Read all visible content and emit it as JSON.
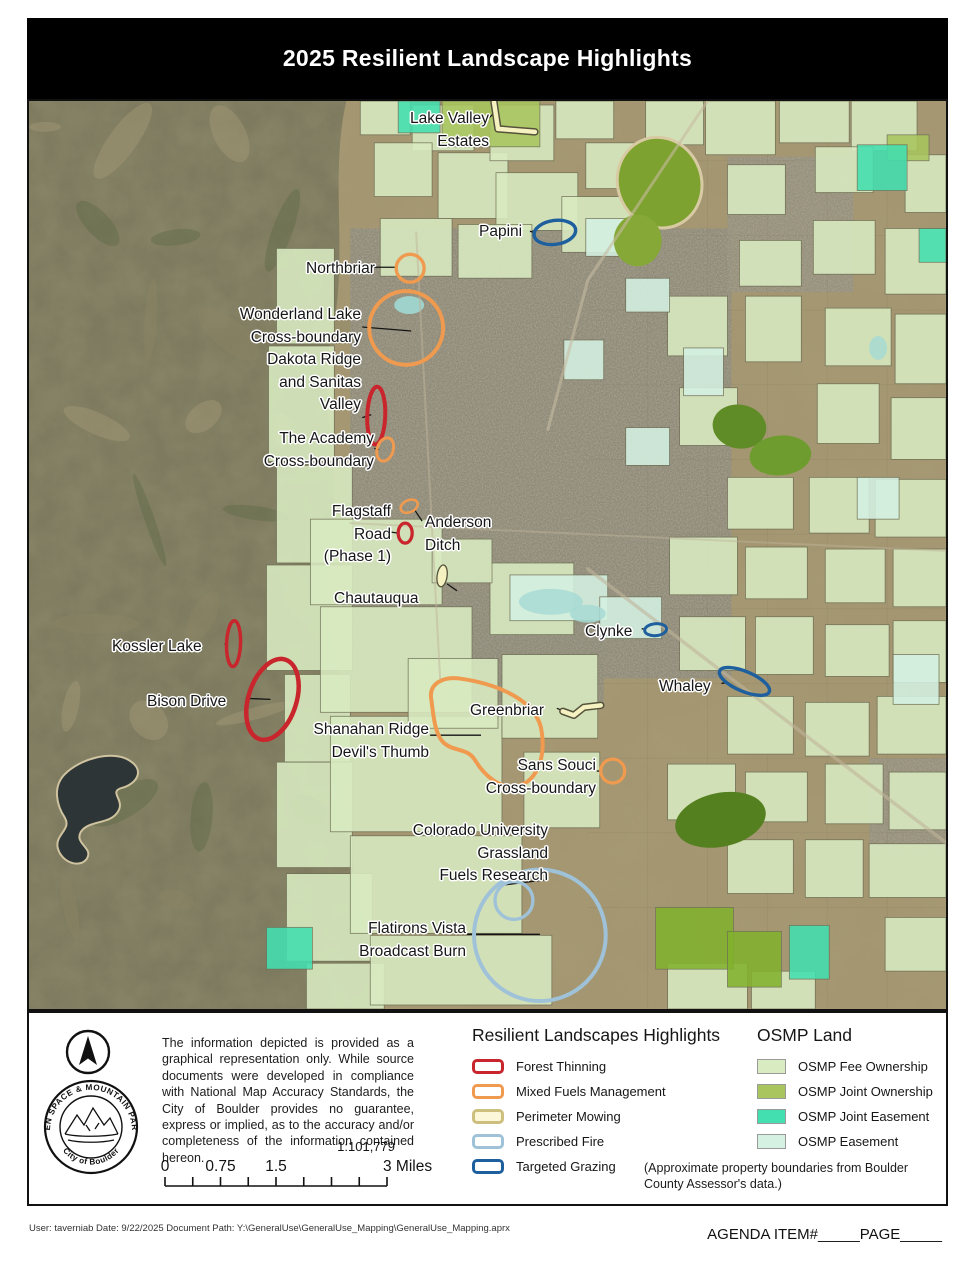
{
  "title": "2025 Resilient Landscape Highlights",
  "colors": {
    "forest_thinning": "#C9252C",
    "mixed_fuels": "#EF9A4F",
    "perimeter_fill": "#F6F1C0",
    "perimeter_casing": "#55523C",
    "perimeter_legend_border": "#CDBF7D",
    "prescribed_fire": "#9FC2D8",
    "targeted_grazing": "#1E5F9E",
    "fee_ownership": "#D9EBC1",
    "joint_ownership": "#A9C55E",
    "joint_easement": "#43DFB0",
    "easement": "#D4F1E2",
    "leader": "#151515"
  },
  "map_labels": [
    {
      "id": "lake-valley-estates",
      "lines": [
        "Lake Valley",
        "Estates"
      ],
      "align": "right",
      "x": 460,
      "y": 7
    },
    {
      "id": "papini",
      "lines": [
        "Papini"
      ],
      "align": "left",
      "x": 450,
      "y": 120
    },
    {
      "id": "northbriar",
      "lines": [
        "Northbriar"
      ],
      "align": "left",
      "x": 277,
      "y": 157
    },
    {
      "id": "wonderland",
      "lines": [
        "Wonderland Lake",
        "Cross-boundary"
      ],
      "align": "right",
      "x": 332,
      "y": 203
    },
    {
      "id": "dakota",
      "lines": [
        "Dakota Ridge",
        "and Sanitas",
        "Valley"
      ],
      "align": "right",
      "x": 332,
      "y": 248
    },
    {
      "id": "academy",
      "lines": [
        "The Academy",
        "Cross-boundary"
      ],
      "align": "right",
      "x": 345,
      "y": 327
    },
    {
      "id": "flagstaff",
      "lines": [
        "Flagstaff",
        "Road",
        "(Phase 1)"
      ],
      "align": "right",
      "x": 362,
      "y": 400
    },
    {
      "id": "anderson",
      "lines": [
        "Anderson",
        "Ditch"
      ],
      "align": "left",
      "x": 396,
      "y": 411
    },
    {
      "id": "chautauqua",
      "lines": [
        "Chautauqua"
      ],
      "align": "left",
      "x": 305,
      "y": 487
    },
    {
      "id": "clynke",
      "lines": [
        "Clynke"
      ],
      "align": "left",
      "x": 556,
      "y": 520
    },
    {
      "id": "kossler",
      "lines": [
        "Kossler Lake"
      ],
      "align": "left",
      "x": 83,
      "y": 535
    },
    {
      "id": "whaley",
      "lines": [
        "Whaley"
      ],
      "align": "left",
      "x": 630,
      "y": 575
    },
    {
      "id": "bison",
      "lines": [
        "Bison Drive"
      ],
      "align": "left",
      "x": 118,
      "y": 590
    },
    {
      "id": "greenbriar",
      "lines": [
        "Greenbriar"
      ],
      "align": "left",
      "x": 441,
      "y": 599
    },
    {
      "id": "shanahan",
      "lines": [
        "Shanahan Ridge",
        "Devil's Thumb"
      ],
      "align": "right",
      "x": 400,
      "y": 618
    },
    {
      "id": "sans-souci",
      "lines": [
        "Sans Souci",
        "Cross-boundary"
      ],
      "align": "right",
      "x": 567,
      "y": 654
    },
    {
      "id": "cu-grassland",
      "lines": [
        "Colorado University",
        "Grassland",
        "Fuels Research"
      ],
      "align": "right",
      "x": 519,
      "y": 719
    },
    {
      "id": "flatirons",
      "lines": [
        "Flatirons Vista",
        "Broadcast Burn"
      ],
      "align": "right",
      "x": 437,
      "y": 817
    }
  ],
  "map_markers": [
    {
      "id": "lake-valley-mow",
      "type": "mowline",
      "pts": [
        [
          466,
          1
        ],
        [
          470,
          28
        ],
        [
          507,
          31
        ]
      ]
    },
    {
      "id": "greenbriar-mow",
      "type": "mowline",
      "pts": [
        [
          535,
          613
        ],
        [
          546,
          617
        ],
        [
          556,
          609
        ],
        [
          573,
          607
        ]
      ]
    },
    {
      "id": "chautauqua-mow",
      "type": "mowellipse",
      "c": [
        414,
        477
      ],
      "r": [
        5,
        11
      ],
      "rot": 8
    },
    {
      "id": "papini-grazing",
      "type": "ellipse",
      "c": [
        527,
        132
      ],
      "r": [
        21,
        12
      ],
      "rot": -8,
      "color": "targeted_grazing",
      "w": 3.4
    },
    {
      "id": "northbriar-fuels",
      "type": "ellipse",
      "c": [
        382,
        168
      ],
      "r": [
        14,
        14
      ],
      "rot": 0,
      "color": "mixed_fuels",
      "w": 3.4
    },
    {
      "id": "wonderland-fuels",
      "type": "ellipse",
      "c": [
        378,
        228
      ],
      "r": [
        37,
        37
      ],
      "rot": 0,
      "color": "mixed_fuels",
      "w": 4
    },
    {
      "id": "dakota-thinning",
      "type": "ellipse",
      "c": [
        348,
        316
      ],
      "r": [
        9,
        29
      ],
      "rot": 2,
      "color": "forest_thinning",
      "w": 4
    },
    {
      "id": "academy-fuels",
      "type": "ellipse",
      "c": [
        357,
        350
      ],
      "r": [
        8,
        12
      ],
      "rot": 18,
      "color": "mixed_fuels",
      "w": 3
    },
    {
      "id": "flagstaff-thinning",
      "type": "ellipse",
      "c": [
        377,
        434
      ],
      "r": [
        7,
        10
      ],
      "rot": 0,
      "color": "forest_thinning",
      "w": 3.3
    },
    {
      "id": "anderson-fuels",
      "type": "ellipse",
      "c": [
        381,
        407
      ],
      "r": [
        9,
        6
      ],
      "rot": -25,
      "color": "mixed_fuels",
      "w": 2.6
    },
    {
      "id": "clynke-grazing",
      "type": "ellipse",
      "c": [
        628,
        531
      ],
      "r": [
        11,
        6
      ],
      "rot": -5,
      "color": "targeted_grazing",
      "w": 3
    },
    {
      "id": "kossler-thinning",
      "type": "ellipse",
      "c": [
        205,
        545
      ],
      "r": [
        7,
        23
      ],
      "rot": 2,
      "color": "forest_thinning",
      "w": 3.5
    },
    {
      "id": "whaley-grazing",
      "type": "ellipse",
      "c": [
        717,
        583
      ],
      "r": [
        27,
        10
      ],
      "rot": 23,
      "color": "targeted_grazing",
      "w": 3.4
    },
    {
      "id": "bison-thinning",
      "type": "ellipse",
      "c": [
        244,
        601
      ],
      "r": [
        24,
        42
      ],
      "rot": 18,
      "color": "forest_thinning",
      "w": 4.5
    },
    {
      "id": "shanahan-fuels",
      "type": "path",
      "d": "M 403,600 C 401,585 415,578 431,580 C 460,584 505,597 513,629 C 519,659 509,683 490,688 C 472,692 456,677 447,662 C 439,649 425,654 415,644 C 406,635 405,613 403,600 Z",
      "color": "mixed_fuels",
      "w": 4
    },
    {
      "id": "sans-souci-fuels",
      "type": "ellipse",
      "c": [
        585,
        673
      ],
      "r": [
        12,
        12
      ],
      "rot": 0,
      "color": "mixed_fuels",
      "w": 3.3
    },
    {
      "id": "cu-fire",
      "type": "ellipse",
      "c": [
        486,
        803
      ],
      "r": [
        19,
        19
      ],
      "rot": 0,
      "color": "prescribed_fire",
      "w": 3.4
    },
    {
      "id": "flatirons-fire",
      "type": "ellipse",
      "c": [
        512,
        838
      ],
      "r": [
        66,
        66
      ],
      "rot": 0,
      "color": "prescribed_fire",
      "w": 4
    }
  ],
  "map_leaders": [
    [
      [
        459,
        19
      ],
      [
        466,
        12
      ]
    ],
    [
      [
        502,
        131
      ],
      [
        507,
        132
      ]
    ],
    [
      [
        346,
        167
      ],
      [
        368,
        167
      ]
    ],
    [
      [
        334,
        227
      ],
      [
        383,
        231
      ]
    ],
    [
      [
        334,
        318
      ],
      [
        343,
        315
      ]
    ],
    [
      [
        346,
        349
      ],
      [
        351,
        350
      ]
    ],
    [
      [
        363,
        433
      ],
      [
        370,
        434
      ]
    ],
    [
      [
        394,
        422
      ],
      [
        386,
        410
      ]
    ],
    [
      [
        419,
        485
      ],
      [
        429,
        492
      ]
    ],
    [
      [
        614,
        530
      ],
      [
        618,
        531
      ]
    ],
    [
      [
        196,
        545
      ],
      [
        199,
        546
      ]
    ],
    [
      [
        694,
        585
      ],
      [
        700,
        584
      ]
    ],
    [
      [
        217,
        600
      ],
      [
        242,
        601
      ]
    ],
    [
      [
        529,
        610
      ],
      [
        534,
        612
      ]
    ],
    [
      [
        402,
        637
      ],
      [
        453,
        637
      ]
    ],
    [
      [
        569,
        673
      ],
      [
        574,
        673
      ]
    ],
    [
      [
        471,
        788
      ],
      [
        519,
        782
      ]
    ],
    [
      [
        439,
        837
      ],
      [
        512,
        837
      ]
    ]
  ],
  "legend": {
    "highlights": {
      "title": "Resilient Landscapes Highlights",
      "items": [
        {
          "label": "Forest Thinning",
          "color": "forest_thinning",
          "style": "outline"
        },
        {
          "label": "Mixed Fuels Management",
          "color": "mixed_fuels",
          "style": "outline"
        },
        {
          "label": "Perimeter Mowing",
          "color": "perimeter_legend_border",
          "style": "outline-mow"
        },
        {
          "label": "Prescribed Fire",
          "color": "prescribed_fire",
          "style": "outline"
        },
        {
          "label": "Targeted Grazing",
          "color": "targeted_grazing",
          "style": "outline"
        }
      ]
    },
    "osmp": {
      "title": "OSMP Land",
      "items": [
        {
          "label": "OSMP Fee Ownership",
          "color": "fee_ownership",
          "style": "fill"
        },
        {
          "label": "OSMP Joint Ownership",
          "color": "joint_ownership",
          "style": "fill"
        },
        {
          "label": "OSMP Joint Easement",
          "color": "joint_easement",
          "style": "fill"
        },
        {
          "label": "OSMP Easement",
          "color": "easement",
          "style": "fill"
        }
      ],
      "note": "(Approximate property boundaries from Boulder County Assessor's data.)"
    }
  },
  "notes": {
    "disclaimer": "The information depicted is provided as a graphical representation only. While source documents were developed in compliance with National Map Accuracy Standards, the City of Boulder provides no guarantee, express or implied, as to the accuracy and/or completeness of the information contained hereon.",
    "scale_ratio": "1:101,779",
    "scale_ticks": [
      "0",
      "0.75",
      "1.5",
      "3 Miles"
    ]
  },
  "logo": {
    "arc_top": "OPEN SPACE & MOUNTAIN PARKS",
    "arc_bottom": "City of Boulder"
  },
  "footer": {
    "left": "User: taverniab  Date: 9/22/2025  Document Path: Y:\\GeneralUse\\GeneralUse_Mapping\\GeneralUse_Mapping.aprx",
    "right": "AGENDA ITEM#_____PAGE_____"
  }
}
